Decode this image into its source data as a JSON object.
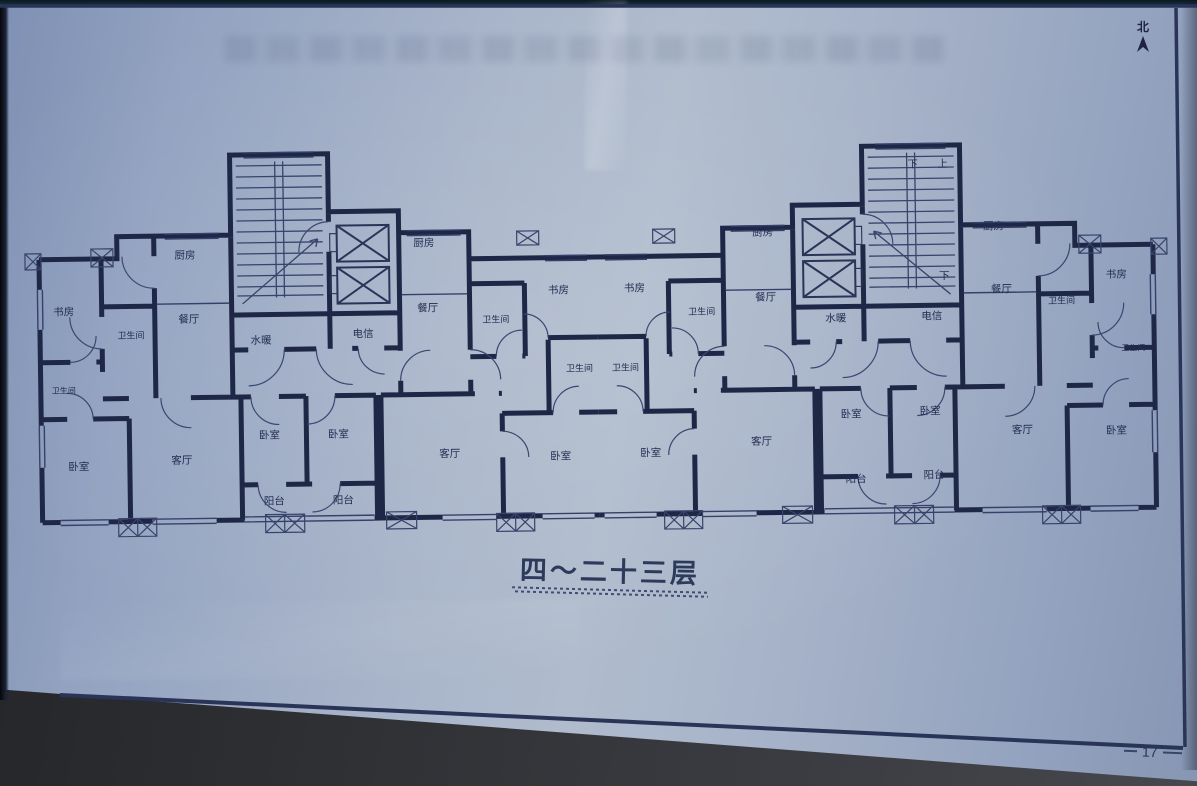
{
  "page": {
    "north_label": "北",
    "floor_caption": "四～二十三层",
    "page_number": "17"
  },
  "plan": {
    "labels": [
      "书房",
      "卫生间",
      "厨房",
      "餐厅",
      "卫生间",
      "卧室",
      "客厅",
      "卧室",
      "卧室",
      "阳台",
      "阳台",
      "水暖",
      "电信",
      "厨房",
      "餐厅",
      "卫生间",
      "书房",
      "卫生间",
      "客厅",
      "卧室",
      "书房",
      "卫生间",
      "卫生间",
      "卧室",
      "厨房",
      "餐厅",
      "水暖",
      "电信",
      "下",
      "上",
      "下",
      "客厅",
      "卧室",
      "卧室",
      "阳台",
      "阳台",
      "厨房",
      "餐厅",
      "卫生间",
      "书房",
      "卫生间",
      "客厅",
      "卧室"
    ]
  },
  "colors": {
    "paper": "#a6b2c8",
    "ink": "#1f2747",
    "frame_border": "#2a3457",
    "photo_background": "#35373c"
  }
}
